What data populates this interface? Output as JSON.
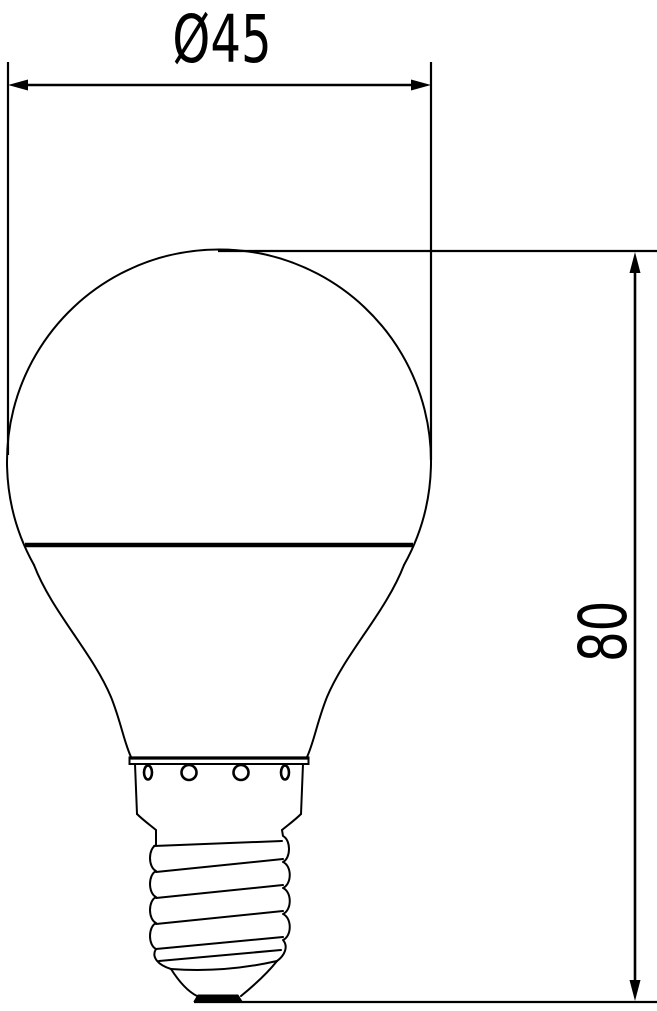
{
  "drawing": {
    "kind": "dimensioned outline drawing of a light bulb with screw base",
    "background_color": "#ffffff",
    "line_color": "#000000"
  },
  "dimensions": {
    "diameter": {
      "label": "Ø45",
      "value": 45
    },
    "height": {
      "label": "80",
      "value": 80
    }
  }
}
